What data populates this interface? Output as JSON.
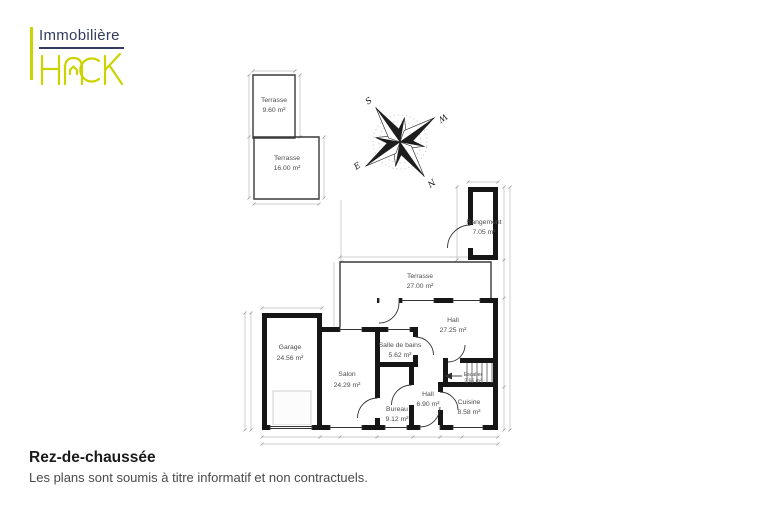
{
  "brand": {
    "name_top": "Immobilière",
    "name_bottom": "HACK",
    "accent_color": "#cbd300",
    "navy_color": "#333b5e"
  },
  "compass": {
    "north": "N",
    "south": "S",
    "east": "E",
    "west": "W"
  },
  "plan": {
    "floor": "Rez-de-chaussée",
    "rooms": [
      {
        "name": "Terrasse",
        "area": "9.60 m²"
      },
      {
        "name": "Terrasse",
        "area": "16.00 m²"
      },
      {
        "name": "Rangement",
        "area": "7.05 m²"
      },
      {
        "name": "Terrasse",
        "area": "27.00 m²"
      },
      {
        "name": "Hall",
        "area": "27.25 m²"
      },
      {
        "name": "Salle de bains",
        "area": "5.62 m²"
      },
      {
        "name": "Garage",
        "area": "24.56 m²"
      },
      {
        "name": "Salon",
        "area": "24.29 m²"
      },
      {
        "name": "Escalier",
        "area": "2.66 m²"
      },
      {
        "name": "Hall",
        "area": "6.90 m²"
      },
      {
        "name": "Bureau",
        "area": "9.12 m²"
      },
      {
        "name": "Cuisine",
        "area": "8.58 m²"
      }
    ]
  },
  "footer": {
    "title": "Rez-de-chaussée",
    "subtitle": "Les plans sont soumis à titre informatif et non contractuels."
  }
}
